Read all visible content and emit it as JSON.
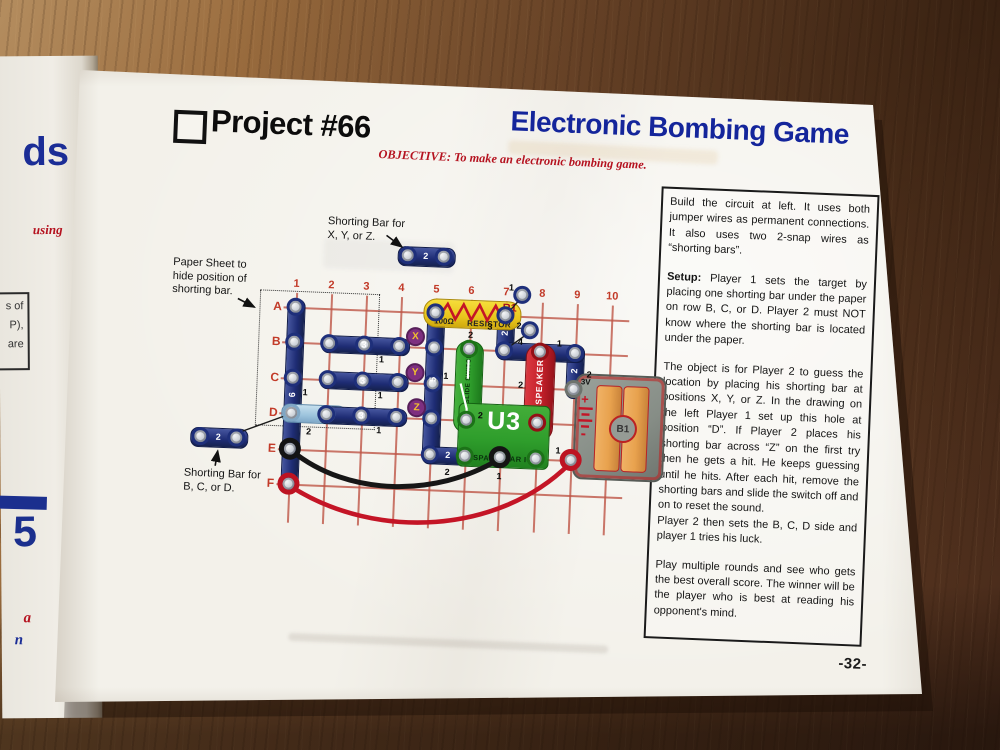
{
  "title_block": {
    "project": "Project #66",
    "title": "Electronic Bombing Game",
    "objective_label": "OBJECTIVE:",
    "objective_text": "To make an electronic bombing game."
  },
  "instructions": {
    "p1": "Build the circuit at left.  It uses both jumper wires as permanent connections.  It also uses two 2-snap wires as “shorting bars”.",
    "p2_lead": "Setup:",
    "p2": "  Player 1 sets the target by placing one shorting bar under the paper on row B, C, or D.  Player 2 must NOT know where the shorting bar is located under the paper.",
    "p3": "The object is for Player 2 to guess the location by placing his shorting bar at positions X, Y, or Z.  In the drawing on the left Player 1 set up this hole at position “D”.  If Player 2 places his shorting bar across “Z” on the first try then he gets a hit.  He keeps guessing until he hits.  After each hit, remove the shorting bars and slide the switch off and on to reset the sound.",
    "p3b": "Player 2 then sets the B, C, D side and player 1 tries his luck.",
    "p4": "Play multiple rounds and see who gets the best overall score.  The winner will be the player who is best at reading his opponent's mind."
  },
  "diagram": {
    "grid": {
      "columns": [
        "1",
        "2",
        "3",
        "4",
        "5",
        "6",
        "7",
        "8",
        "9",
        "10"
      ],
      "rows": [
        "A",
        "B",
        "C",
        "D",
        "E",
        "F"
      ]
    },
    "markers": [
      "X",
      "Y",
      "Z"
    ],
    "labels": {
      "paper_sheet": [
        "Paper Sheet to",
        "hide position of",
        "shorting bar."
      ],
      "bar_xyz": [
        "Shorting Bar for",
        "X, Y, or Z."
      ],
      "bar_bcd": [
        "Shorting Bar for",
        "B, C, or D."
      ]
    },
    "parts": {
      "col1_wire": {
        "count": "6",
        "level": "1"
      },
      "col5_wire": {
        "count": "5",
        "level": "1"
      },
      "col7_wire": {
        "count": "2",
        "level": "3"
      },
      "col9_wire": {
        "count": "2",
        "level": "2"
      },
      "row_b_wire": {
        "count": "3",
        "level": "1"
      },
      "row_c_wire": {
        "count": "3",
        "level": "1"
      },
      "row_d_wire": {
        "count": "3",
        "level": "1"
      },
      "row_b79_wire": {
        "level": "4"
      },
      "row_e_wire": {
        "count": "2",
        "level": "2"
      },
      "shorting_bar_d": {
        "count": "2"
      },
      "shorting_bar_xyz": {
        "count": "2"
      },
      "shorting_bar_bcd": {
        "count": "2"
      },
      "snap_top": {
        "level": "1"
      },
      "snap_mid": {
        "level": "2"
      },
      "resistor": {
        "id": "R1",
        "value": "100Ω",
        "name": "RESISTOR",
        "level": "2"
      },
      "switch": {
        "id": "S1",
        "name": "SLIDE SWITCH",
        "level": "2"
      },
      "speaker": {
        "id": "SP",
        "name": "SPEAKER",
        "level": "2",
        "top_level": "1"
      },
      "ic": {
        "id": "U3",
        "name": "SPACE WAR IC",
        "pin_level": "1"
      },
      "battery": {
        "id": "B1",
        "voltage": "3V",
        "plus": "+",
        "minus": "-",
        "pin_level": "1"
      }
    }
  },
  "footer": {
    "page_number": "-32-"
  },
  "left_page": {
    "heading_fragment": "ds",
    "subtitle_fragment": "using",
    "box_lines": [
      "s of",
      "P),",
      "are"
    ],
    "project_number_fragment": "5",
    "red_fragment": "a",
    "blue_fragment": "n"
  }
}
